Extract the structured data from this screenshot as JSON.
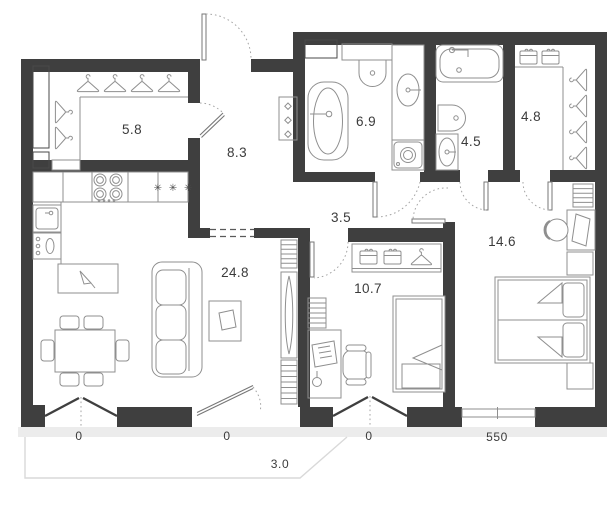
{
  "plan": {
    "rooms": [
      {
        "name": "entry-closet",
        "area": "5.8"
      },
      {
        "name": "hallway",
        "area": "8.3"
      },
      {
        "name": "bathroom",
        "area": "6.9"
      },
      {
        "name": "master-bathroom",
        "area": "4.5"
      },
      {
        "name": "master-closet",
        "area": "4.8"
      },
      {
        "name": "corridor",
        "area": "3.5"
      },
      {
        "name": "kitchen-living-room",
        "area": "24.8"
      },
      {
        "name": "kids-room",
        "area": "10.7"
      },
      {
        "name": "bedroom",
        "area": "14.6"
      }
    ],
    "dimensions": [
      {
        "name": "living-window-left",
        "value": "0"
      },
      {
        "name": "living-balcony-door",
        "value": "0"
      },
      {
        "name": "kids-room-window",
        "value": "0"
      },
      {
        "name": "bedroom-window",
        "value": "550"
      },
      {
        "name": "balcony-width",
        "value": "3.0"
      }
    ],
    "symbols": {
      "fridge": "✳ ✳ ✳"
    },
    "colors": {
      "wall": "#3f3f3f",
      "fixture_line": "#8f8f8f",
      "label": "#3b3b3b",
      "sill": "#ececec",
      "balcony_line": "#d9d9d9"
    }
  }
}
